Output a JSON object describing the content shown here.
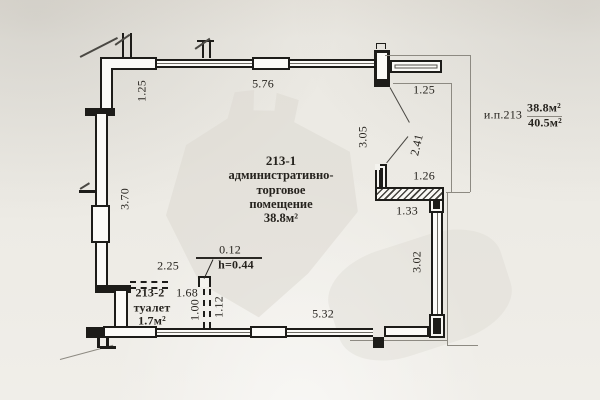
{
  "plan": {
    "unit": {
      "label": "и.п.213",
      "area_upper": "38.8м²",
      "area_lower": "40.5м²"
    },
    "main_room": {
      "number": "213-1",
      "name_line1": "административно-",
      "name_line2": "торговое",
      "name_line3": "помещение",
      "area": "38.8м²"
    },
    "wc": {
      "number": "213-2",
      "name": "туалет",
      "area": "1.7м²"
    },
    "dims": {
      "left_upper": "1.25",
      "top": "5.76",
      "top_right": "1.25",
      "right_v1": "3.05",
      "right_v2": "2.41",
      "right_h1": "1.26",
      "right_h2": "1.33",
      "right_v3": "3.02",
      "bottom": "5.32",
      "left_main": "3.70",
      "wc_top": "2.25",
      "wc_inner": "1.68",
      "wc_depth": "1.00",
      "wc_depth2": "1.12",
      "step_width": "0.12",
      "step_height": "h=0.44"
    },
    "colors": {
      "ink": "#1d1c19",
      "paper": "#edebe5",
      "thin_line": "#8d8a82"
    }
  }
}
